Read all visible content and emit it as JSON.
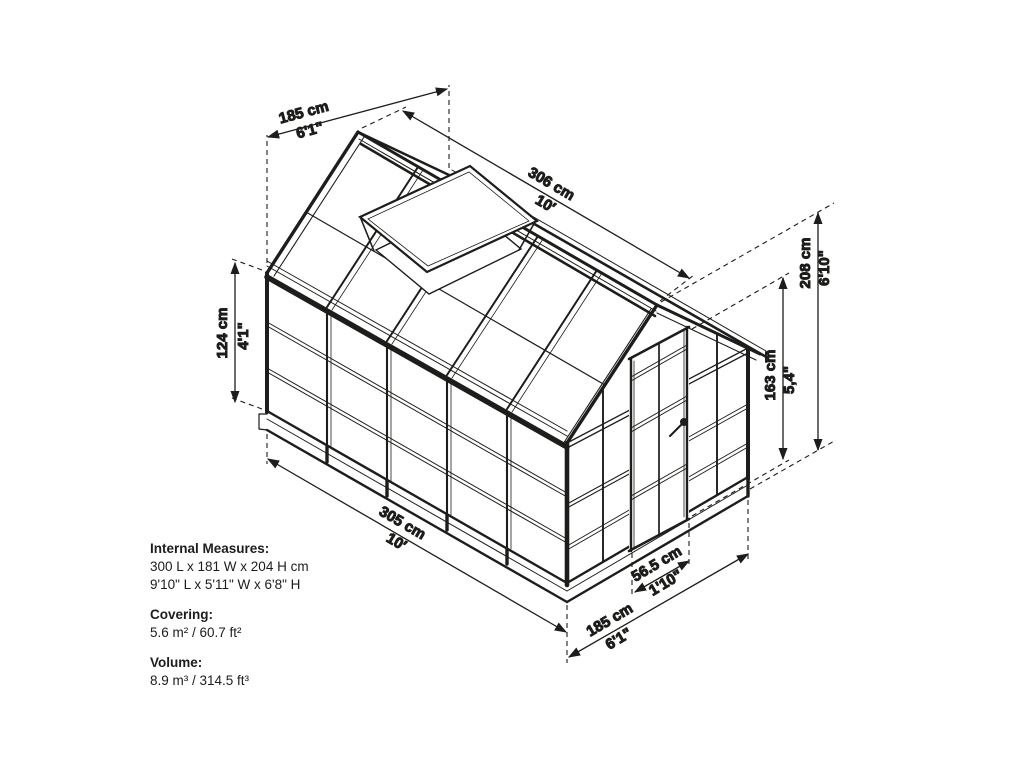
{
  "title": "Greenhouse dimensions diagram",
  "colors": {
    "line": "#1d1d1b",
    "background": "#ffffff"
  },
  "dimensions": {
    "top_width": {
      "cm": "185 cm",
      "imperial": "6'1\""
    },
    "ridge_length": {
      "cm": "306 cm",
      "imperial": "10′"
    },
    "wall_height": {
      "cm": "124 cm",
      "imperial": "4'1\""
    },
    "total_height": {
      "cm": "208 cm",
      "imperial": "6'10\""
    },
    "door_height": {
      "cm": "163 cm",
      "imperial": "5,4\""
    },
    "base_length": {
      "cm": "305 cm",
      "imperial": "10′"
    },
    "door_width": {
      "cm": "56.5 cm",
      "imperial": "1'10\""
    },
    "base_width": {
      "cm": "185 cm",
      "imperial": "6'1\""
    }
  },
  "info": {
    "internal_measures_label": "Internal Measures:",
    "internal_measures_metric": "300 L x 181 W x 204 H cm",
    "internal_measures_imperial": "9'10\" L x 5'11\" W x 6'8\" H",
    "covering_label": "Covering:",
    "covering_value": "5.6 m² / 60.7 ft²",
    "volume_label": "Volume:",
    "volume_value": "8.9 m³ / 314.5 ft³"
  }
}
